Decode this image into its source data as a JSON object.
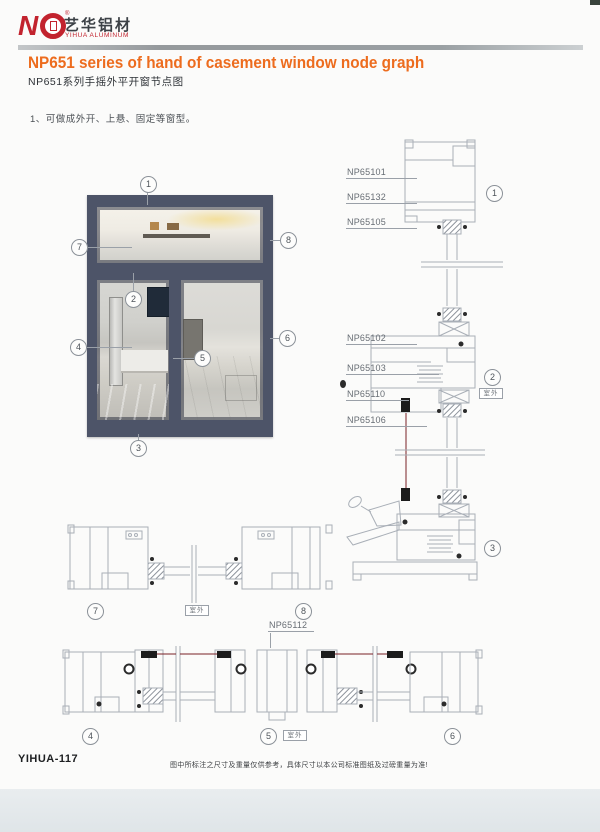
{
  "header": {
    "brand_cn": "艺华铝材",
    "brand_en": "YIHUA ALUMINUM",
    "reg_mark": "®",
    "title_en": "NP651 series of hand of casement window node graph",
    "title_cn": "NP651系列手摇外平开窗节点图"
  },
  "note": "1、可做成外开、上悬、固定等窗型。",
  "outdoor_label": "室外",
  "callouts": {
    "c1": "1",
    "c2": "2",
    "c3": "3",
    "c4": "4",
    "c5": "5",
    "c6": "6",
    "c7": "7",
    "c8": "8"
  },
  "parts": {
    "np65101": "NP65101",
    "np65132": "NP65132",
    "np65105": "NP65105",
    "np65102": "NP65102",
    "np65103": "NP65103",
    "np65110": "NP65110",
    "np65106": "NP65106",
    "np65112": "NP65112"
  },
  "footer": {
    "page_code": "YIHUA-117",
    "disclaimer": "图中所标注之尺寸及重量仅供参考，具体尺寸以本公司标准图纸及过磅重量为准!"
  },
  "colors": {
    "accent_orange": "#ed6c1e",
    "brand_red": "#c2232e",
    "frame_dark": "#4d5468",
    "line_gray": "#a9afb7",
    "rod_red": "#7a2025"
  }
}
